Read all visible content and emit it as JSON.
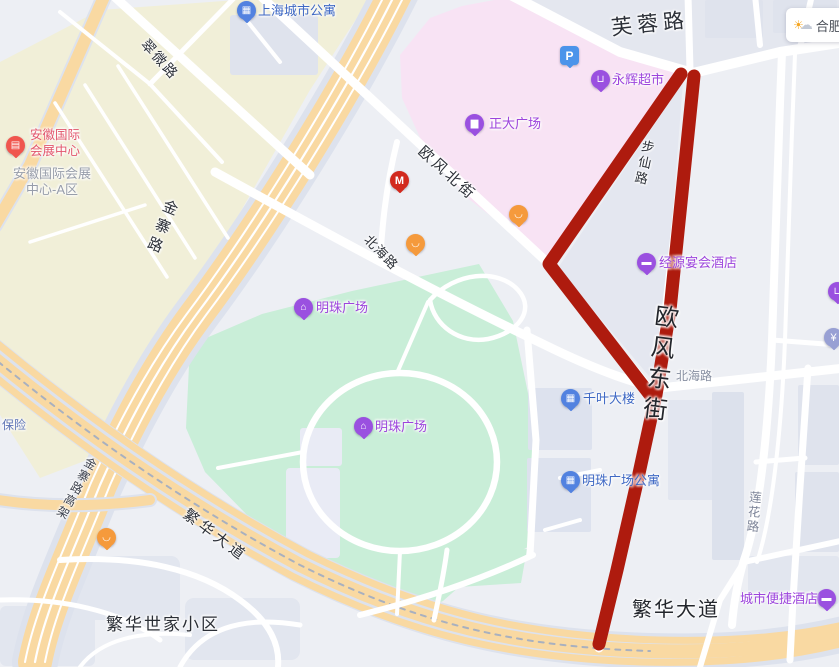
{
  "map": {
    "city_widget": {
      "city": "合肥",
      "icon": "sun-cloud-icon"
    },
    "route_overlay": {
      "color": "#ae1b0e",
      "kind": "highlighted-route"
    }
  },
  "road_labels": {
    "furong": "芙蓉路",
    "cuiwei": "翠微路",
    "jinzhai": "金寨路",
    "jinzhai_elevated": "金寨路高架",
    "oufeng_north": "欧风北街",
    "buxian": "步仙路",
    "beihai": "北海路",
    "oufeng_east": "欧风东街",
    "lianhua": "莲花路",
    "fanhua": "繁华大道",
    "fanhua_estate": "繁华世家小区",
    "baoxian": "保险"
  },
  "pois": {
    "shanghai_city_apartment": {
      "label": "上海城市公寓",
      "icon": "building-icon"
    },
    "parking": {
      "label": "P",
      "icon": "parking-icon"
    },
    "yonghui_supermarket": {
      "label": "永辉超市",
      "icon": "shopping-cart-icon"
    },
    "zhengda_plaza": {
      "label": "正大广场",
      "icon": "shopping-bag-icon"
    },
    "mcdonalds": {
      "label": "M",
      "icon": "mcdonalds-icon"
    },
    "anhui_expo_center": {
      "label": "安徽国际\n会展中心",
      "icon": "exhibition-icon"
    },
    "anhui_expo_area_a": {
      "label": "安徽国际会展\n中心-A区"
    },
    "jingyuan_banquet_hotel": {
      "label": "经源宴会酒店",
      "icon": "hotel-bed-icon"
    },
    "mingzhu_plaza": {
      "label": "明珠广场",
      "icon": "plaza-icon"
    },
    "qianye_building": {
      "label": "千叶大楼",
      "icon": "building-icon"
    },
    "mingzhu_plaza_apartment": {
      "label": "明珠广场公寓",
      "icon": "building-icon"
    },
    "city_comfort_inn": {
      "label": "城市便捷酒店",
      "icon": "hotel-bed-icon"
    },
    "bank": {
      "label": "¥",
      "icon": "bank-icon"
    },
    "restaurant": {
      "icon": "restaurant-icon"
    },
    "cart_edge": {
      "icon": "shopping-cart-icon"
    }
  },
  "colors": {
    "route": "#ae1b0e",
    "park_green": "#c9eed8",
    "mall_pink": "#f8e3f4",
    "expo_cream": "#f1efd8",
    "highway_yellow": "#f9d9a2",
    "poi_purple": "#9c44dc",
    "poi_blue": "#3e68c4"
  }
}
